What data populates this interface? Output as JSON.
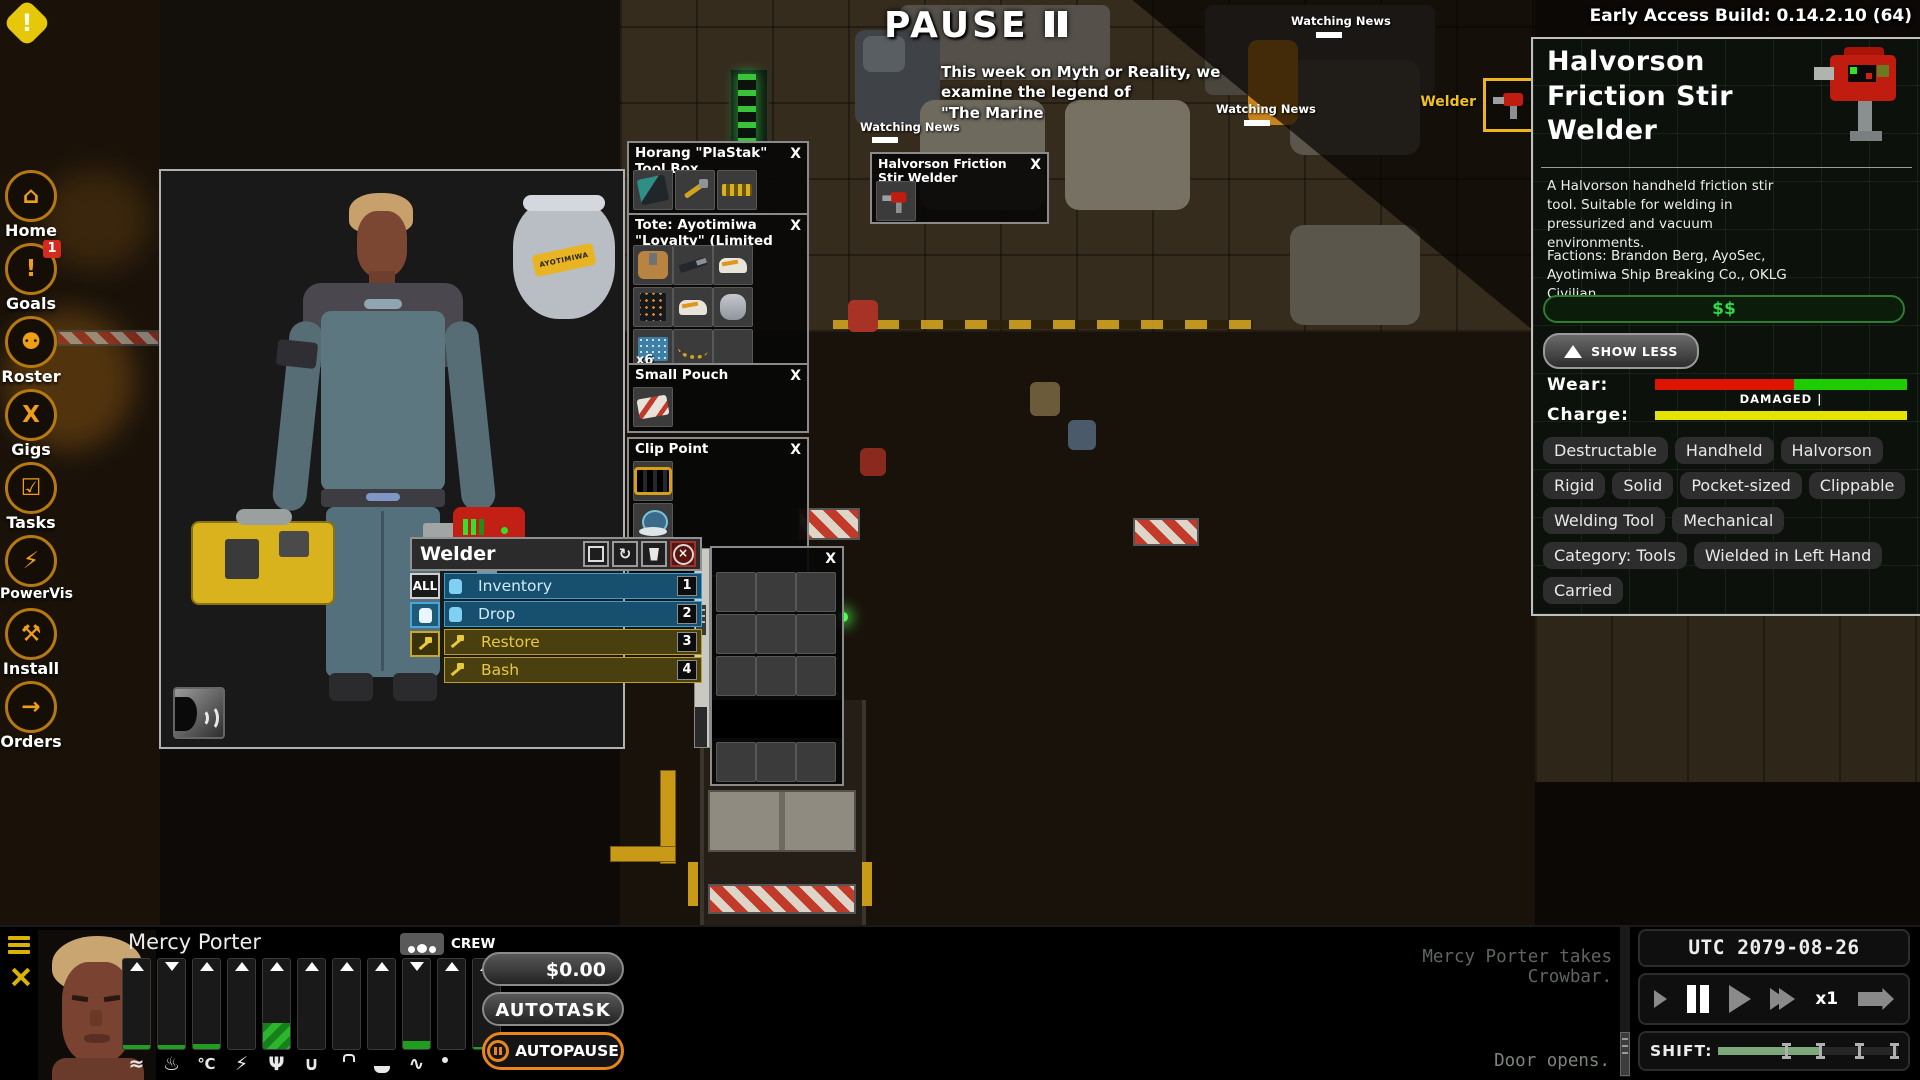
{
  "ui": {
    "close_label": "X"
  },
  "build_label": "Early Access Build: 0.14.2.10 (64)",
  "pause_label": "PAUSE",
  "news": {
    "ticker_line1": "This week on Myth or Reality, we examine the legend of",
    "ticker_line2": "\"The Marine",
    "watching_label": "Watching News"
  },
  "sidebar": {
    "items": [
      {
        "label": "Home",
        "badge": ""
      },
      {
        "label": "Goals",
        "badge": "1"
      },
      {
        "label": "Roster",
        "badge": ""
      },
      {
        "label": "Gigs",
        "badge": ""
      },
      {
        "label": "Tasks",
        "badge": ""
      },
      {
        "label": "PowerVis",
        "badge": ""
      },
      {
        "label": "Install",
        "badge": ""
      },
      {
        "label": "Orders",
        "badge": ""
      }
    ]
  },
  "world": {
    "welder_pickup_label": "Welder",
    "container_window": {
      "title": "Halvorson Friction Stir Welder"
    }
  },
  "inventory": {
    "toolbox": {
      "title": "Horang \"PlaStak\" Tool Box"
    },
    "tote": {
      "title": "Tote: Ayotimiwa \"Loyalty\" (Limited",
      "stack_count": "x6"
    },
    "small_pouch": {
      "title": "Small Pouch"
    },
    "clip_point": {
      "title": "Clip Point"
    },
    "bag_label": "AYOTIMIWA"
  },
  "context_menu": {
    "title": "Welder",
    "filter_all": "ALL",
    "items": [
      {
        "label": "Inventory",
        "hotkey": "1"
      },
      {
        "label": "Drop",
        "hotkey": "2"
      },
      {
        "label": "Restore",
        "hotkey": "3"
      },
      {
        "label": "Bash",
        "hotkey": "4"
      },
      {
        "label": "Dismantle",
        "hotkey": ""
      }
    ]
  },
  "details": {
    "title": "Halvorson Friction Stir Welder",
    "description": "A Halvorson handheld friction stir tool. Suitable for welding in pressurized and vacuum environments.",
    "factions": "Factions: Brandon Berg, AyoSec, Ayotimiwa Ship Breaking Co., OKLG Civilian",
    "price_label": "$$",
    "show_less_label": "SHOW LESS",
    "wear_label": "Wear:",
    "wear_status": "DAMAGED |",
    "wear_red_pct": 55,
    "charge_label": "Charge:",
    "charge_pct": 100,
    "tags": [
      "Destructable",
      "Handheld",
      "Halvorson",
      "Rigid",
      "Solid",
      "Pocket-sized",
      "Clippable",
      "Welding Tool",
      "Mechanical",
      "Category: Tools",
      "Wielded in Left Hand",
      "Carried"
    ],
    "colors": {
      "wear_red": "#dd1500",
      "wear_green": "#1ecc00",
      "charge_yellow": "#e4e400",
      "price_green": "#31d848",
      "accent_orange": "#e8861c"
    }
  },
  "crew": {
    "name": "Mercy Porter",
    "badge": "CREW",
    "money": "$0.00",
    "autotask": "AUTOTASK",
    "autopause": "AUTOPAUSE",
    "stats": [
      {
        "name": "air",
        "fill": 4,
        "arrow": "up"
      },
      {
        "name": "heat",
        "fill": 4,
        "arrow": "down"
      },
      {
        "name": "temperature",
        "fill": 6,
        "arrow": "up"
      },
      {
        "name": "energy",
        "fill": 0,
        "arrow": "up"
      },
      {
        "name": "food",
        "fill": 29,
        "arrow": "up"
      },
      {
        "name": "water",
        "fill": 0,
        "arrow": "up"
      },
      {
        "name": "weight",
        "fill": 0,
        "arrow": "up"
      },
      {
        "name": "toilet",
        "fill": 0,
        "arrow": "up"
      },
      {
        "name": "health",
        "fill": 9,
        "arrow": "down"
      },
      {
        "name": "sleep",
        "fill": 0,
        "arrow": "up"
      },
      {
        "name": "hygiene",
        "fill": 2,
        "arrow": "up"
      }
    ]
  },
  "log": {
    "messages": [
      "Mercy Porter is going to get Crowbar.",
      "",
      "Mercy Porter starts prying open Door.",
      "Mercy Porter pries Door open.",
      "↘ Mercy Porter is winded.",
      "Mercy Porter starts opening Door."
    ],
    "faded_top": "Mercy Porter takes Crowbar.",
    "faded_bottom": "Door opens."
  },
  "timebar": {
    "clock": "UTC 2079-08-26 14:00:41",
    "speed": "x1",
    "shift_label": "SHIFT:"
  }
}
